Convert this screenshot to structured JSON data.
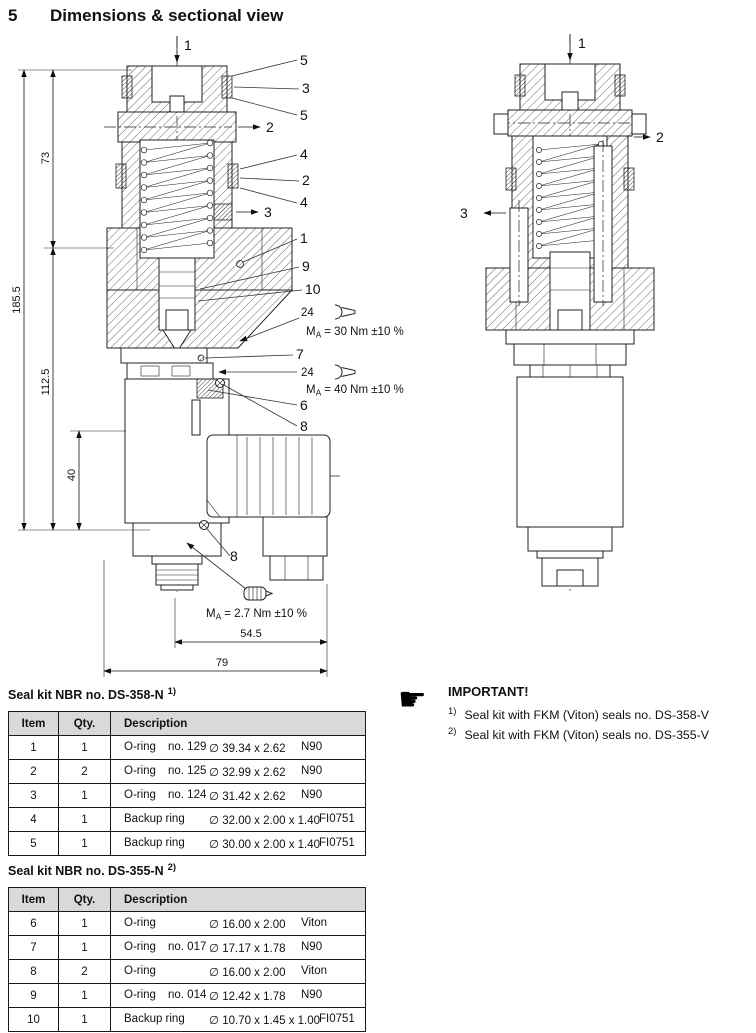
{
  "header": {
    "section_number": "5",
    "title": "Dimensions & sectional view"
  },
  "drawing": {
    "left": {
      "callouts": [
        "1",
        "5",
        "3",
        "5",
        "2",
        "4",
        "2",
        "4",
        "3",
        "1",
        "9",
        "10",
        "7",
        "6",
        "8",
        "8"
      ],
      "dimensions": {
        "overall_height": "185.5",
        "upper_height": "73",
        "lower_height": "112.5",
        "connector_height": "40",
        "width_inner": "54.5",
        "width_overall": "79"
      },
      "torques": [
        {
          "wrench": "24",
          "icon": "open-end-wrench-icon",
          "label": "M",
          "sub": "A",
          "value": "= 30 Nm ±10 %"
        },
        {
          "wrench": "24",
          "icon": "open-end-wrench-icon",
          "label": "M",
          "sub": "A",
          "value": "= 40 Nm ±10 %"
        },
        {
          "icon": "hand-tight-icon",
          "label": "M",
          "sub": "A",
          "value": "= 2.7 Nm ±10 %"
        }
      ]
    },
    "right": {
      "callouts": [
        "1",
        "2",
        "3"
      ]
    }
  },
  "seal_kits": [
    {
      "title": "Seal kit NBR no. DS-358-N",
      "footnote_ref": "1)",
      "columns": [
        "Item",
        "Qty.",
        "Description"
      ],
      "rows": [
        {
          "item": "1",
          "qty": "1",
          "name": "O-ring",
          "no": "no. 129",
          "size": "∅ 39.34 x 2.62",
          "material": "N90"
        },
        {
          "item": "2",
          "qty": "2",
          "name": "O-ring",
          "no": "no. 125",
          "size": "∅ 32.99 x 2.62",
          "material": "N90"
        },
        {
          "item": "3",
          "qty": "1",
          "name": "O-ring",
          "no": "no. 124",
          "size": "∅ 31.42 x 2.62",
          "material": "N90"
        },
        {
          "item": "4",
          "qty": "1",
          "name": "Backup ring",
          "no": "",
          "size": "∅ 32.00 x 2.00 x 1.40",
          "material": "FI0751"
        },
        {
          "item": "5",
          "qty": "1",
          "name": "Backup ring",
          "no": "",
          "size": "∅ 30.00 x 2.00 x 1.40",
          "material": "FI0751"
        }
      ]
    },
    {
      "title": "Seal kit NBR no. DS-355-N",
      "footnote_ref": "2)",
      "columns": [
        "Item",
        "Qty.",
        "Description"
      ],
      "rows": [
        {
          "item": "6",
          "qty": "1",
          "name": "O-ring",
          "no": "",
          "size": "∅ 16.00 x 2.00",
          "material": "Viton"
        },
        {
          "item": "7",
          "qty": "1",
          "name": "O-ring",
          "no": "no. 017",
          "size": "∅ 17.17 x 1.78",
          "material": "N90"
        },
        {
          "item": "8",
          "qty": "2",
          "name": "O-ring",
          "no": "",
          "size": "∅ 16.00 x 2.00",
          "material": "Viton"
        },
        {
          "item": "9",
          "qty": "1",
          "name": "O-ring",
          "no": "no. 014",
          "size": "∅ 12.42 x 1.78",
          "material": "N90"
        },
        {
          "item": "10",
          "qty": "1",
          "name": "Backup ring",
          "no": "",
          "size": "∅ 10.70 x 1.45 x 1.00",
          "material": "FI0751"
        }
      ]
    }
  ],
  "important": {
    "title": "IMPORTANT!",
    "icon": "pointing-hand-icon",
    "icon_glyph": "☛",
    "items": [
      {
        "ref": "1)",
        "text": "Seal kit with FKM (Viton) seals no. DS-358-V"
      },
      {
        "ref": "2)",
        "text": "Seal kit with FKM (Viton) seals no. DS-355-V"
      }
    ]
  }
}
